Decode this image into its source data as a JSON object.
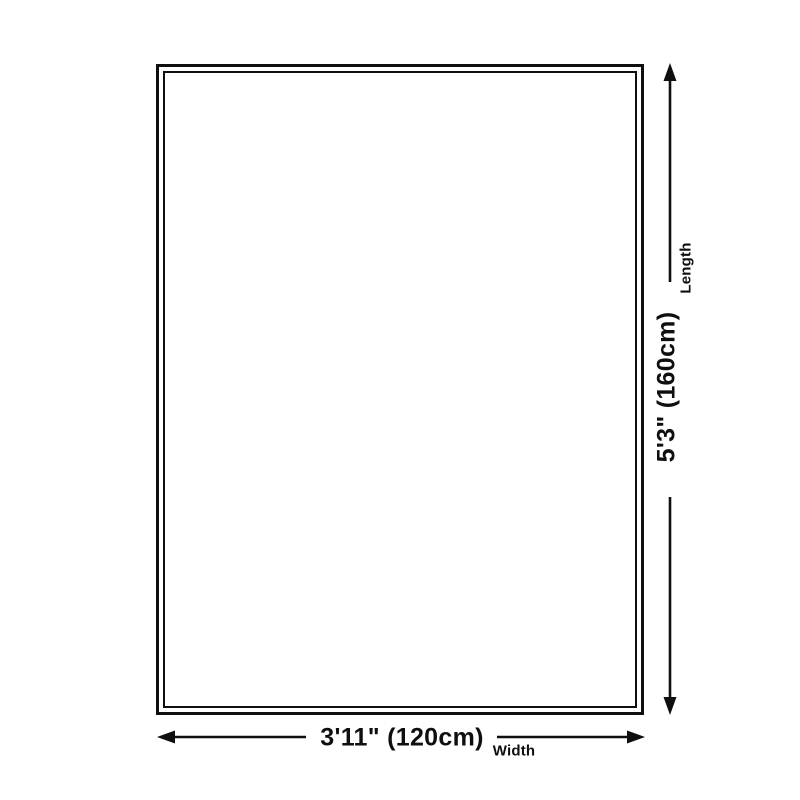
{
  "diagram": {
    "background": "#ffffff",
    "line_color": "#0f0f0f",
    "length": {
      "value_label": "5'3\" (160cm)",
      "axis_label": "Length"
    },
    "width": {
      "value_label": "3'11\" (120cm)",
      "axis_label": "Width"
    }
  }
}
